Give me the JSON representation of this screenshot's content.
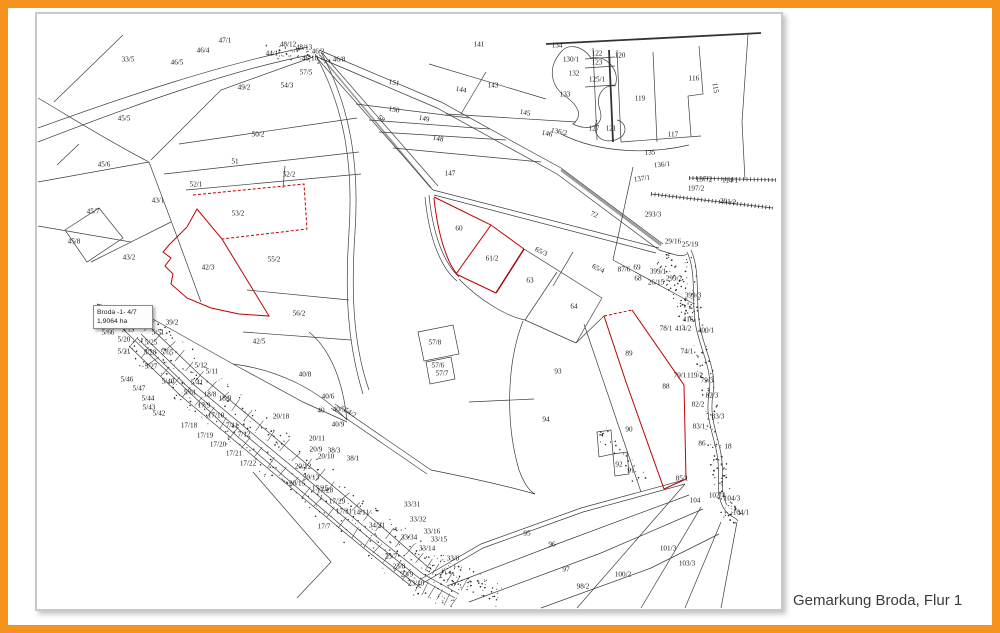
{
  "caption": "Gemarkung Broda, Flur 1",
  "frame": {
    "border_color": "#F6921E"
  },
  "map": {
    "title": "Cadastral map of Gemarkung Broda, Flur 1",
    "highlight_color": "#C00000",
    "line_color": "#3d3d3d",
    "highlighted_parcels": [
      "53/2",
      "42/3",
      "61/2",
      "89"
    ],
    "tooltip": {
      "line1": "Broda -1- 4/7",
      "line2": "1,9064 ha"
    },
    "parcel_labels": [
      {
        "t": "33/5",
        "x": 127,
        "y": 58,
        "s": 8
      },
      {
        "t": "46/4",
        "x": 202,
        "y": 49
      },
      {
        "t": "47/1",
        "x": 224,
        "y": 39
      },
      {
        "t": "46/5",
        "x": 176,
        "y": 61
      },
      {
        "t": "44/1",
        "x": 271,
        "y": 52
      },
      {
        "t": "48/12",
        "x": 287,
        "y": 43
      },
      {
        "t": "48/13",
        "x": 303,
        "y": 46
      },
      {
        "t": "46/2",
        "x": 317,
        "y": 50
      },
      {
        "t": "46/10",
        "x": 309,
        "y": 57
      },
      {
        "t": "46/8",
        "x": 338,
        "y": 58
      },
      {
        "t": "57/5",
        "x": 305,
        "y": 71
      },
      {
        "t": "54/3",
        "x": 286,
        "y": 84
      },
      {
        "t": "49/2",
        "x": 243,
        "y": 86,
        "s": 8
      },
      {
        "t": "45/5",
        "x": 123,
        "y": 117,
        "s": 8
      },
      {
        "t": "50/2",
        "x": 257,
        "y": 133,
        "s": 8
      },
      {
        "t": "51",
        "x": 234,
        "y": 160,
        "s": 8.5
      },
      {
        "t": "45/6",
        "x": 103,
        "y": 163,
        "s": 8
      },
      {
        "t": "52/2",
        "x": 288,
        "y": 173
      },
      {
        "t": "52/1",
        "x": 195,
        "y": 183
      },
      {
        "t": "43/1",
        "x": 157,
        "y": 199,
        "s": 8
      },
      {
        "t": "45/7",
        "x": 92,
        "y": 210
      },
      {
        "t": "53/2",
        "x": 237,
        "y": 212,
        "s": 8
      },
      {
        "t": "45/8",
        "x": 73,
        "y": 240
      },
      {
        "t": "43/2",
        "x": 128,
        "y": 256
      },
      {
        "t": "55/2",
        "x": 273,
        "y": 258,
        "s": 8
      },
      {
        "t": "42/3",
        "x": 207,
        "y": 266,
        "s": 8
      },
      {
        "t": "56/2",
        "x": 298,
        "y": 312,
        "s": 8
      },
      {
        "t": "39/2",
        "x": 171,
        "y": 321
      },
      {
        "t": "42/5",
        "x": 258,
        "y": 340,
        "s": 8
      },
      {
        "t": "58",
        "x": 380,
        "y": 117,
        "a": 40
      },
      {
        "t": "141",
        "x": 478,
        "y": 43,
        "s": 8
      },
      {
        "t": "151",
        "x": 393,
        "y": 81,
        "s": 8,
        "a": 10
      },
      {
        "t": "144",
        "x": 460,
        "y": 88,
        "s": 8,
        "a": 10
      },
      {
        "t": "143",
        "x": 492,
        "y": 84,
        "s": 8
      },
      {
        "t": "150",
        "x": 393,
        "y": 108,
        "s": 8,
        "a": 10
      },
      {
        "t": "149",
        "x": 423,
        "y": 117,
        "a": 10
      },
      {
        "t": "148",
        "x": 437,
        "y": 137,
        "s": 8,
        "a": 10
      },
      {
        "t": "147",
        "x": 449,
        "y": 172,
        "s": 8
      },
      {
        "t": "145",
        "x": 524,
        "y": 111,
        "s": 8,
        "a": 10
      },
      {
        "t": "146",
        "x": 546,
        "y": 132,
        "a": 10
      },
      {
        "t": "136/2",
        "x": 558,
        "y": 130,
        "a": 10
      },
      {
        "t": "134",
        "x": 556,
        "y": 44
      },
      {
        "t": "130/1",
        "x": 570,
        "y": 58
      },
      {
        "t": "132",
        "x": 573,
        "y": 72
      },
      {
        "t": "133",
        "x": 564,
        "y": 93,
        "s": 8
      },
      {
        "t": "122",
        "x": 596,
        "y": 52
      },
      {
        "t": "123",
        "x": 596,
        "y": 61
      },
      {
        "t": "120",
        "x": 619,
        "y": 54
      },
      {
        "t": "125/1",
        "x": 596,
        "y": 78
      },
      {
        "t": "119",
        "x": 639,
        "y": 97,
        "s": 8.5
      },
      {
        "t": "116",
        "x": 693,
        "y": 77,
        "s": 8.5
      },
      {
        "t": "115",
        "x": 714,
        "y": 86,
        "a": 80
      },
      {
        "t": "117",
        "x": 672,
        "y": 133,
        "s": 8
      },
      {
        "t": "127",
        "x": 593,
        "y": 127
      },
      {
        "t": "121",
        "x": 610,
        "y": 127
      },
      {
        "t": "135",
        "x": 649,
        "y": 151,
        "a": -4
      },
      {
        "t": "136/1",
        "x": 661,
        "y": 163,
        "a": -6
      },
      {
        "t": "137/1",
        "x": 641,
        "y": 177,
        "a": -8
      },
      {
        "t": "137/2",
        "x": 703,
        "y": 178
      },
      {
        "t": "114/1",
        "x": 729,
        "y": 179
      },
      {
        "t": "197/2",
        "x": 695,
        "y": 187
      },
      {
        "t": "291/2",
        "x": 727,
        "y": 200,
        "a": 6
      },
      {
        "t": "293/3",
        "x": 652,
        "y": 213,
        "s": 8
      },
      {
        "t": "72",
        "x": 593,
        "y": 213,
        "s": 8,
        "a": 24
      },
      {
        "t": "60",
        "x": 458,
        "y": 227,
        "s": 8.5
      },
      {
        "t": "61/2",
        "x": 491,
        "y": 257,
        "s": 8.5
      },
      {
        "t": "65/3",
        "x": 540,
        "y": 250,
        "a": 25
      },
      {
        "t": "63",
        "x": 529,
        "y": 279,
        "s": 8.5
      },
      {
        "t": "65/4",
        "x": 597,
        "y": 267,
        "a": 25
      },
      {
        "t": "64",
        "x": 573,
        "y": 305,
        "s": 8.5
      },
      {
        "t": "57/8",
        "x": 434,
        "y": 341
      },
      {
        "t": "57/6",
        "x": 437,
        "y": 364
      },
      {
        "t": "57/7",
        "x": 441,
        "y": 372
      },
      {
        "t": "93",
        "x": 557,
        "y": 370,
        "s": 8.5
      },
      {
        "t": "94",
        "x": 545,
        "y": 418,
        "s": 8.5
      },
      {
        "t": "89",
        "x": 628,
        "y": 352,
        "s": 8.5
      },
      {
        "t": "88",
        "x": 665,
        "y": 385,
        "s": 8.5
      },
      {
        "t": "90",
        "x": 628,
        "y": 428,
        "s": 8.5
      },
      {
        "t": "92",
        "x": 618,
        "y": 463
      },
      {
        "t": "91",
        "x": 630,
        "y": 469
      },
      {
        "t": "29/16",
        "x": 672,
        "y": 240,
        "s": 6.5
      },
      {
        "t": "25/19",
        "x": 689,
        "y": 243,
        "s": 6.5
      },
      {
        "t": "69",
        "x": 636,
        "y": 266,
        "s": 6.5
      },
      {
        "t": "68",
        "x": 637,
        "y": 277,
        "s": 6.5
      },
      {
        "t": "87/6",
        "x": 623,
        "y": 268,
        "s": 6.5
      },
      {
        "t": "399/1",
        "x": 657,
        "y": 270,
        "s": 6.5
      },
      {
        "t": "299/2",
        "x": 673,
        "y": 277,
        "s": 6.5
      },
      {
        "t": "26/15",
        "x": 655,
        "y": 281,
        "s": 6.5
      },
      {
        "t": "399/3",
        "x": 692,
        "y": 294
      },
      {
        "t": "416",
        "x": 687,
        "y": 318,
        "s": 6.5
      },
      {
        "t": "78/1",
        "x": 665,
        "y": 327,
        "s": 6.5
      },
      {
        "t": "414/2",
        "x": 682,
        "y": 327,
        "s": 6.5
      },
      {
        "t": "400/1",
        "x": 705,
        "y": 329
      },
      {
        "t": "74/1",
        "x": 686,
        "y": 350,
        "s": 6.5
      },
      {
        "t": "79/1",
        "x": 679,
        "y": 374,
        "s": 6.5
      },
      {
        "t": "119/2",
        "x": 694,
        "y": 374,
        "s": 6.5
      },
      {
        "t": "79/3",
        "x": 706,
        "y": 379,
        "s": 6.5
      },
      {
        "t": "82/3",
        "x": 711,
        "y": 394,
        "s": 6.5
      },
      {
        "t": "82/2",
        "x": 697,
        "y": 403,
        "s": 6.5
      },
      {
        "t": "83/3",
        "x": 717,
        "y": 415,
        "s": 6.5
      },
      {
        "t": "83/1",
        "x": 698,
        "y": 425,
        "s": 6.5
      },
      {
        "t": "86",
        "x": 701,
        "y": 442,
        "s": 6.5
      },
      {
        "t": "18",
        "x": 727,
        "y": 445
      },
      {
        "t": "85/1",
        "x": 681,
        "y": 477,
        "s": 6.5
      },
      {
        "t": "104",
        "x": 694,
        "y": 499,
        "s": 8
      },
      {
        "t": "102/4",
        "x": 716,
        "y": 494,
        "s": 6.5
      },
      {
        "t": "104/3",
        "x": 731,
        "y": 497,
        "s": 6.5
      },
      {
        "t": "104/1",
        "x": 740,
        "y": 511,
        "s": 6.5
      },
      {
        "t": "101/3",
        "x": 667,
        "y": 547
      },
      {
        "t": "103/3",
        "x": 686,
        "y": 562
      },
      {
        "t": "100/2",
        "x": 622,
        "y": 573
      },
      {
        "t": "98/2",
        "x": 582,
        "y": 585
      },
      {
        "t": "95",
        "x": 526,
        "y": 532,
        "s": 8
      },
      {
        "t": "96",
        "x": 551,
        "y": 543,
        "s": 8
      },
      {
        "t": "97",
        "x": 565,
        "y": 568,
        "s": 8
      },
      {
        "t": "33/31",
        "x": 411,
        "y": 503,
        "s": 6.5
      },
      {
        "t": "33/32",
        "x": 417,
        "y": 518
      },
      {
        "t": "33/34",
        "x": 408,
        "y": 536,
        "s": 6.5
      },
      {
        "t": "33/16",
        "x": 431,
        "y": 530,
        "s": 6.5
      },
      {
        "t": "33/15",
        "x": 438,
        "y": 538,
        "s": 6.5
      },
      {
        "t": "33/14",
        "x": 426,
        "y": 547,
        "s": 6.5
      },
      {
        "t": "33/8",
        "x": 452,
        "y": 557
      },
      {
        "t": "23/7",
        "x": 390,
        "y": 555
      },
      {
        "t": "23/8",
        "x": 398,
        "y": 565
      },
      {
        "t": "23/9",
        "x": 406,
        "y": 573
      },
      {
        "t": "23/10",
        "x": 415,
        "y": 582
      },
      {
        "t": "17/7",
        "x": 323,
        "y": 525,
        "s": 8
      },
      {
        "t": "17/28",
        "x": 324,
        "y": 489,
        "s": 6.5
      },
      {
        "t": "17/29",
        "x": 336,
        "y": 500,
        "s": 6.5
      },
      {
        "t": "17/31",
        "x": 343,
        "y": 510,
        "s": 6.5
      },
      {
        "t": "14/11",
        "x": 360,
        "y": 511,
        "s": 6.5
      },
      {
        "t": "34/31",
        "x": 376,
        "y": 524,
        "s": 6.5
      },
      {
        "t": "38/1",
        "x": 352,
        "y": 457,
        "s": 6.5
      },
      {
        "t": "38/3",
        "x": 333,
        "y": 449,
        "s": 6.5
      },
      {
        "t": "20/9",
        "x": 315,
        "y": 448,
        "s": 6.5
      },
      {
        "t": "20/10",
        "x": 325,
        "y": 455,
        "s": 6.5
      },
      {
        "t": "20/11",
        "x": 316,
        "y": 437,
        "s": 6.5
      },
      {
        "t": "20/12",
        "x": 302,
        "y": 465,
        "s": 6.5
      },
      {
        "t": "20/13",
        "x": 310,
        "y": 476,
        "s": 6.5
      },
      {
        "t": "20/15",
        "x": 296,
        "y": 482,
        "s": 6.5
      },
      {
        "t": "17/25",
        "x": 319,
        "y": 487,
        "s": 6.5
      },
      {
        "t": "20/18",
        "x": 280,
        "y": 415,
        "s": 6.5
      },
      {
        "t": "18/8",
        "x": 209,
        "y": 393,
        "s": 6.5
      },
      {
        "t": "18/9",
        "x": 224,
        "y": 397,
        "s": 6.5
      },
      {
        "t": "17/9",
        "x": 203,
        "y": 404,
        "s": 6.5
      },
      {
        "t": "17/10",
        "x": 215,
        "y": 414,
        "s": 6.5
      },
      {
        "t": "7/11",
        "x": 231,
        "y": 424,
        "s": 6.5
      },
      {
        "t": "7/12",
        "x": 243,
        "y": 433,
        "s": 6.5
      },
      {
        "t": "17/18",
        "x": 188,
        "y": 424,
        "s": 6.5
      },
      {
        "t": "17/19",
        "x": 204,
        "y": 434,
        "s": 6.5
      },
      {
        "t": "17/20",
        "x": 217,
        "y": 443,
        "s": 6.5
      },
      {
        "t": "17/21",
        "x": 233,
        "y": 452,
        "s": 6.5
      },
      {
        "t": "17/22",
        "x": 247,
        "y": 462,
        "s": 6.5
      },
      {
        "t": "5/66",
        "x": 107,
        "y": 331,
        "s": 6.5
      },
      {
        "t": "5/19",
        "x": 127,
        "y": 328,
        "s": 6.5
      },
      {
        "t": "5/20",
        "x": 123,
        "y": 338,
        "s": 6.5
      },
      {
        "t": "5/21",
        "x": 123,
        "y": 350,
        "s": 6.5
      },
      {
        "t": "5/51",
        "x": 157,
        "y": 331,
        "s": 6.5
      },
      {
        "t": "5/25",
        "x": 150,
        "y": 341,
        "s": 6.5
      },
      {
        "t": "5/28",
        "x": 149,
        "y": 351,
        "s": 6.5
      },
      {
        "t": "5/27",
        "x": 150,
        "y": 365,
        "s": 6.5
      },
      {
        "t": "5/65",
        "x": 166,
        "y": 351,
        "s": 6.5
      },
      {
        "t": "5/12",
        "x": 200,
        "y": 364,
        "s": 6.5
      },
      {
        "t": "5/11",
        "x": 211,
        "y": 370,
        "s": 6.5
      },
      {
        "t": "5/40",
        "x": 167,
        "y": 380,
        "s": 6.5
      },
      {
        "t": "5/41",
        "x": 196,
        "y": 381,
        "s": 6.5
      },
      {
        "t": "5/46",
        "x": 126,
        "y": 378,
        "s": 6.5
      },
      {
        "t": "5/47",
        "x": 138,
        "y": 387,
        "s": 6.5
      },
      {
        "t": "5/44",
        "x": 147,
        "y": 397,
        "s": 6.5
      },
      {
        "t": "5/43",
        "x": 148,
        "y": 406,
        "s": 6.5
      },
      {
        "t": "5/42",
        "x": 158,
        "y": 412,
        "s": 6.5
      },
      {
        "t": "5/61",
        "x": 189,
        "y": 391,
        "s": 6.5
      },
      {
        "t": "40/8",
        "x": 304,
        "y": 373,
        "s": 8
      },
      {
        "t": "40/6",
        "x": 327,
        "y": 395,
        "s": 6.5
      },
      {
        "t": "40",
        "x": 320,
        "y": 409,
        "s": 6.5
      },
      {
        "t": "40/5",
        "x": 338,
        "y": 408,
        "s": 6.5
      },
      {
        "t": "54/2",
        "x": 349,
        "y": 411,
        "s": 6.5,
        "a": 30
      },
      {
        "t": "40/9",
        "x": 337,
        "y": 423,
        "s": 6.5
      }
    ]
  }
}
